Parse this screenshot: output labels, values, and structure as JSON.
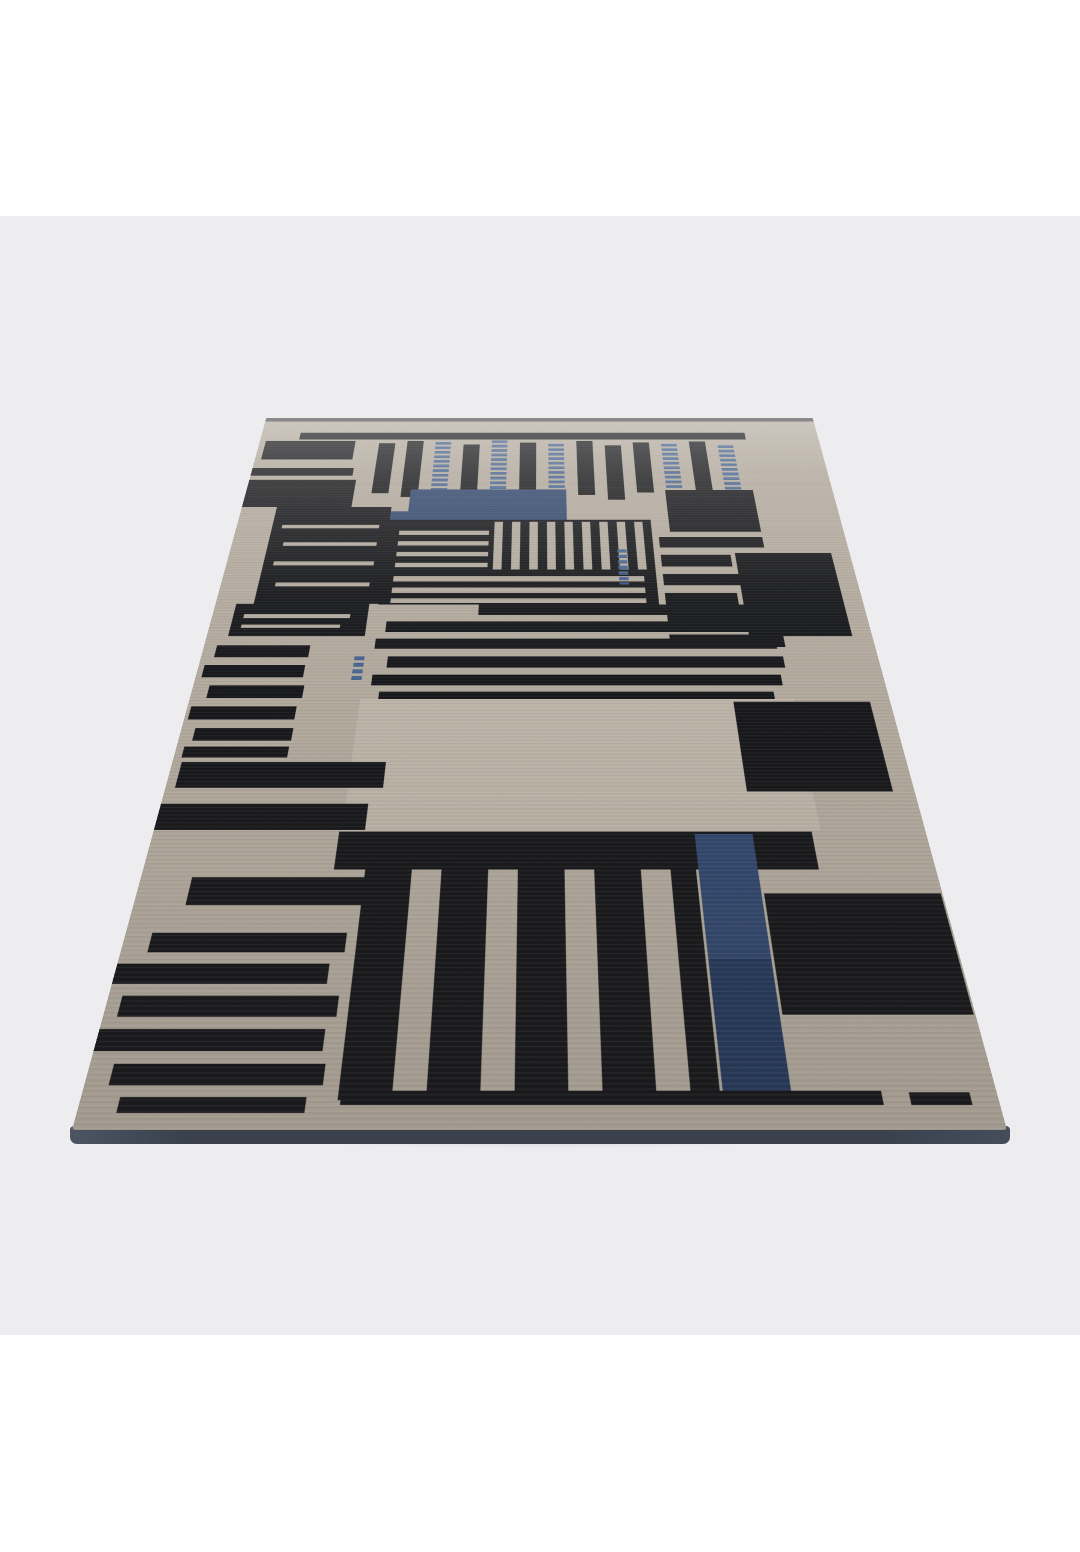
{
  "scene": {
    "alt": "Studio product photograph of a rectangular hand-knotted rug viewed in perspective, lying flat on a pale gray floor. Abstract pattern of irregular black bars and stripes on a greige ground with two navy blue rectangles near the top and a long navy blue vertical stripe near the bottom right, dark slate bound edge visible along the front.",
    "background": {
      "page": "#ffffff",
      "backdrop": "#ededef"
    }
  },
  "rug": {
    "plane_width": 935,
    "plane_height": 1487,
    "palette": {
      "ground": "#b3aa9e",
      "ground_light": "#d6cfc3",
      "black": "#17181b",
      "blue": "#32486e",
      "blue_deep": "#263a5c",
      "blue_dash": "#41608f",
      "edge_line": "#3a3b3f",
      "rug_edge": "#3b424e"
    },
    "shapes": [
      {
        "t": "rect",
        "x": 0,
        "y": 0,
        "w": 935,
        "h": 13,
        "f": "edge_line",
        "o": 0.85
      },
      {
        "t": "rect",
        "x": 65,
        "y": 52,
        "w": 748,
        "h": 23,
        "f": "black"
      },
      {
        "t": "rect",
        "x": 10,
        "y": 80,
        "w": 150,
        "h": 62,
        "f": "black"
      },
      {
        "t": "rect",
        "x": 0,
        "y": 170,
        "w": 165,
        "h": 25,
        "f": "black"
      },
      {
        "t": "rect",
        "x": 0,
        "y": 208,
        "w": 172,
        "h": 84,
        "f": "black"
      },
      {
        "t": "rect",
        "x": 200,
        "y": 88,
        "w": 27,
        "h": 162,
        "f": "black"
      },
      {
        "t": "rect",
        "x": 247,
        "y": 80,
        "w": 27,
        "h": 182,
        "f": "black"
      },
      {
        "t": "dashcol",
        "x": 294,
        "y": 84,
        "w": 26,
        "h": 184,
        "f": "blue_dash"
      },
      {
        "t": "rect",
        "x": 341,
        "y": 92,
        "w": 27,
        "h": 166,
        "f": "black"
      },
      {
        "t": "dashcol",
        "x": 388,
        "y": 78,
        "w": 26,
        "h": 194,
        "f": "blue_dash"
      },
      {
        "t": "rect",
        "x": 435,
        "y": 86,
        "w": 27,
        "h": 166,
        "f": "black"
      },
      {
        "t": "dashcol",
        "x": 482,
        "y": 90,
        "w": 26,
        "h": 175,
        "f": "blue_dash"
      },
      {
        "t": "rect",
        "x": 529,
        "y": 80,
        "w": 27,
        "h": 175,
        "f": "black"
      },
      {
        "t": "rect",
        "x": 576,
        "y": 95,
        "w": 27,
        "h": 175,
        "f": "black"
      },
      {
        "t": "rect",
        "x": 623,
        "y": 85,
        "w": 27,
        "h": 163,
        "f": "black"
      },
      {
        "t": "dashcol",
        "x": 670,
        "y": 90,
        "w": 26,
        "h": 150,
        "f": "blue_dash"
      },
      {
        "t": "rect",
        "x": 717,
        "y": 82,
        "w": 27,
        "h": 160,
        "f": "black"
      },
      {
        "t": "dashcol",
        "x": 764,
        "y": 95,
        "w": 26,
        "h": 177,
        "f": "blue_dash"
      },
      {
        "t": "rect",
        "x": 668,
        "y": 240,
        "w": 140,
        "h": 125,
        "f": "black"
      },
      {
        "t": "rect",
        "x": 262,
        "y": 238,
        "w": 248,
        "h": 95,
        "f": "blue"
      },
      {
        "t": "rect",
        "x": 175,
        "y": 305,
        "w": 185,
        "h": 90,
        "f": "blue"
      },
      {
        "t": "rect",
        "x": 55,
        "y": 292,
        "w": 180,
        "h": 268,
        "f": "black"
      },
      {
        "t": "rect",
        "x": 70,
        "y": 345,
        "w": 150,
        "h": 10,
        "f": "ground"
      },
      {
        "t": "rect",
        "x": 78,
        "y": 395,
        "w": 142,
        "h": 10,
        "f": "ground"
      },
      {
        "t": "rect",
        "x": 70,
        "y": 448,
        "w": 150,
        "h": 11,
        "f": "ground"
      },
      {
        "t": "rect",
        "x": 80,
        "y": 505,
        "w": 138,
        "h": 10,
        "f": "ground"
      },
      {
        "t": "rect",
        "x": 235,
        "y": 330,
        "w": 405,
        "h": 232,
        "f": "black"
      },
      {
        "t": "vstripes",
        "x": 398,
        "y": 336,
        "w": 232,
        "h": 134,
        "bar": 13,
        "gap": 14,
        "f": "ground"
      },
      {
        "t": "rect",
        "x": 252,
        "y": 362,
        "w": 138,
        "h": 12,
        "f": "ground"
      },
      {
        "t": "rect",
        "x": 252,
        "y": 392,
        "w": 138,
        "h": 12,
        "f": "ground"
      },
      {
        "t": "rect",
        "x": 252,
        "y": 422,
        "w": 138,
        "h": 12,
        "f": "ground"
      },
      {
        "t": "rect",
        "x": 252,
        "y": 452,
        "w": 138,
        "h": 12,
        "f": "ground"
      },
      {
        "t": "rect",
        "x": 252,
        "y": 488,
        "w": 370,
        "h": 14,
        "f": "ground"
      },
      {
        "t": "rect",
        "x": 252,
        "y": 518,
        "w": 370,
        "h": 14,
        "f": "ground"
      },
      {
        "t": "rect",
        "x": 252,
        "y": 546,
        "w": 370,
        "h": 12,
        "f": "ground"
      },
      {
        "t": "dashcol",
        "x": 585,
        "y": 415,
        "w": 14,
        "h": 95,
        "f": "blue_dash"
      },
      {
        "t": "rect",
        "x": 650,
        "y": 380,
        "w": 158,
        "h": 30,
        "f": "black"
      },
      {
        "t": "rect",
        "x": 650,
        "y": 430,
        "w": 105,
        "h": 32,
        "f": "black"
      },
      {
        "t": "rect",
        "x": 650,
        "y": 482,
        "w": 150,
        "h": 30,
        "f": "black"
      },
      {
        "t": "rect",
        "x": 650,
        "y": 532,
        "w": 105,
        "h": 32,
        "f": "black"
      },
      {
        "t": "rect",
        "x": 650,
        "y": 584,
        "w": 155,
        "h": 30,
        "f": "black"
      },
      {
        "t": "rect",
        "x": 650,
        "y": 636,
        "w": 160,
        "h": 30,
        "f": "black"
      },
      {
        "t": "rect",
        "x": 762,
        "y": 425,
        "w": 145,
        "h": 215,
        "f": "black"
      },
      {
        "t": "rect",
        "x": 380,
        "y": 562,
        "w": 420,
        "h": 26,
        "f": "black"
      },
      {
        "t": "rect",
        "x": 250,
        "y": 604,
        "w": 556,
        "h": 26,
        "f": "black"
      },
      {
        "t": "rect",
        "x": 238,
        "y": 646,
        "w": 560,
        "h": 24,
        "f": "black"
      },
      {
        "t": "rect",
        "x": 258,
        "y": 688,
        "w": 546,
        "h": 26,
        "f": "black"
      },
      {
        "t": "rect",
        "x": 240,
        "y": 730,
        "w": 556,
        "h": 24,
        "f": "black"
      },
      {
        "t": "rect",
        "x": 252,
        "y": 768,
        "w": 530,
        "h": 16,
        "f": "black"
      },
      {
        "t": "rect",
        "x": 30,
        "y": 560,
        "w": 192,
        "h": 80,
        "f": "black"
      },
      {
        "t": "rect",
        "x": 45,
        "y": 586,
        "w": 152,
        "h": 10,
        "f": "ground"
      },
      {
        "t": "rect",
        "x": 45,
        "y": 612,
        "w": 140,
        "h": 8,
        "f": "ground"
      },
      {
        "t": "dashcol",
        "x": 212,
        "y": 688,
        "w": 14,
        "h": 54,
        "f": "blue_dash"
      },
      {
        "t": "rect",
        "x": 18,
        "y": 662,
        "w": 130,
        "h": 28,
        "f": "black"
      },
      {
        "t": "rect",
        "x": 8,
        "y": 708,
        "w": 138,
        "h": 28,
        "f": "black"
      },
      {
        "t": "rect",
        "x": 22,
        "y": 754,
        "w": 128,
        "h": 28,
        "f": "black"
      },
      {
        "t": "rect",
        "x": 5,
        "y": 800,
        "w": 140,
        "h": 28,
        "f": "black"
      },
      {
        "t": "rect",
        "x": 18,
        "y": 846,
        "w": 128,
        "h": 26,
        "f": "black"
      },
      {
        "t": "rect",
        "x": 10,
        "y": 884,
        "w": 135,
        "h": 22,
        "f": "black"
      },
      {
        "t": "rect",
        "x": 228,
        "y": 784,
        "w": 580,
        "h": 260,
        "f": "ground_light",
        "o": 0.3
      },
      {
        "t": "rect",
        "x": 726,
        "y": 790,
        "w": 182,
        "h": 182,
        "f": "black"
      },
      {
        "t": "rect",
        "x": 12,
        "y": 915,
        "w": 260,
        "h": 50,
        "f": "black"
      },
      {
        "t": "rect",
        "x": 0,
        "y": 995,
        "w": 256,
        "h": 48,
        "f": "black"
      },
      {
        "t": "rect",
        "x": 225,
        "y": 1046,
        "w": 572,
        "h": 66,
        "f": "black"
      },
      {
        "t": "rect",
        "x": 60,
        "y": 1125,
        "w": 205,
        "h": 46,
        "f": "black"
      },
      {
        "t": "rect",
        "x": 262,
        "y": 1112,
        "w": 55,
        "h": 338,
        "f": "black"
      },
      {
        "t": "rect",
        "x": 352,
        "y": 1112,
        "w": 55,
        "h": 330,
        "f": "black"
      },
      {
        "t": "rect",
        "x": 442,
        "y": 1112,
        "w": 55,
        "h": 338,
        "f": "black"
      },
      {
        "t": "rect",
        "x": 532,
        "y": 1112,
        "w": 55,
        "h": 326,
        "f": "black"
      },
      {
        "t": "rect",
        "x": 622,
        "y": 1112,
        "w": 30,
        "h": 330,
        "f": "black"
      },
      {
        "t": "rect",
        "x": 655,
        "y": 1050,
        "w": 70,
        "h": 205,
        "f": "blue"
      },
      {
        "t": "rect",
        "x": 655,
        "y": 1255,
        "w": 70,
        "h": 185,
        "f": "blue_deep"
      },
      {
        "t": "rect",
        "x": 728,
        "y": 1152,
        "w": 205,
        "h": 184,
        "f": "black"
      },
      {
        "t": "rect",
        "x": 30,
        "y": 1215,
        "w": 220,
        "h": 30,
        "f": "black"
      },
      {
        "t": "rect",
        "x": 0,
        "y": 1262,
        "w": 235,
        "h": 30,
        "f": "black"
      },
      {
        "t": "rect",
        "x": 15,
        "y": 1309,
        "w": 235,
        "h": 30,
        "f": "black"
      },
      {
        "t": "rect",
        "x": 0,
        "y": 1356,
        "w": 240,
        "h": 30,
        "f": "black"
      },
      {
        "t": "rect",
        "x": 25,
        "y": 1403,
        "w": 220,
        "h": 28,
        "f": "black"
      },
      {
        "t": "rect",
        "x": 40,
        "y": 1446,
        "w": 190,
        "h": 20,
        "f": "black"
      },
      {
        "t": "rect",
        "x": 265,
        "y": 1438,
        "w": 552,
        "h": 18,
        "f": "black"
      },
      {
        "t": "rect",
        "x": 845,
        "y": 1440,
        "w": 62,
        "h": 16,
        "f": "black"
      }
    ]
  }
}
